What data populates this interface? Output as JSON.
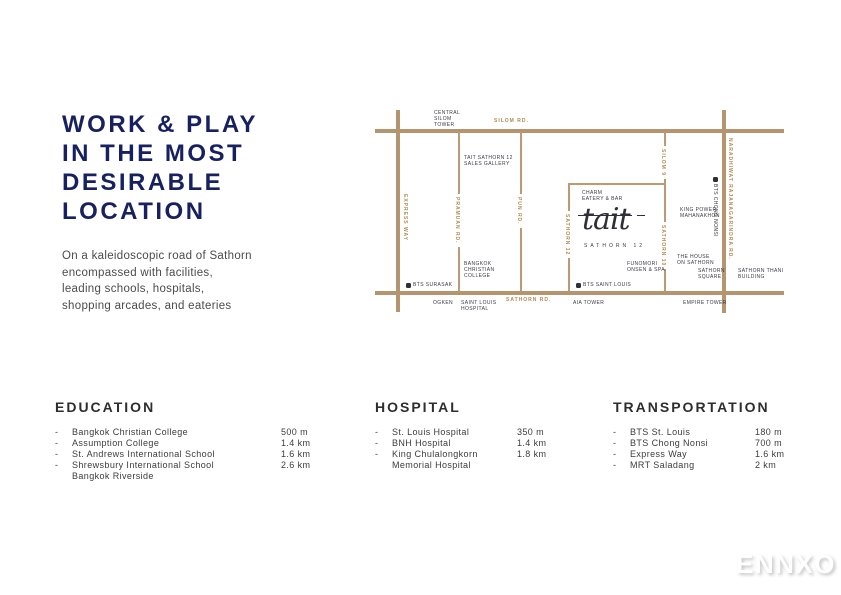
{
  "intro": {
    "title_lines": [
      "WORK & PLAY",
      "IN THE MOST",
      "DESIRABLE",
      "LOCATION"
    ],
    "description": "On a kaleidoscopic road of Sathorn encompassed with facilities, leading schools, hospitals, shopping arcades, and eateries"
  },
  "colors": {
    "heading_navy": "#17215f",
    "road_tan": "#b59470",
    "road_label_tan": "#b08a54",
    "map_text_dark": "#3a3b45"
  },
  "map": {
    "roads": {
      "silom": "SILOM RD.",
      "sathorn": "SATHORN RD.",
      "express_way": "EXPRESS WAY",
      "pramuan": "PRAMUAN RD.",
      "pun": "PUN RD.",
      "sathorn12": "SATHORN 12",
      "silom9": "SILOM 9",
      "sathorn10": "SATHORN 10",
      "naradhiwat": "NARADHIWAT RAJANAGARINDRA RD."
    },
    "places": {
      "central_silom_tower": "CENTRAL\nSILOM\nTOWER",
      "sales_gallery": "TAIT SATHORN 12\nSALES GALLERY",
      "bangkok_christian_college": "BANGKOK\nCHRISTIAN\nCOLLEGE",
      "bts_surasak": "BTS SURASAK",
      "ogken": "OGKEN",
      "saint_louis_hospital": "SAINT LOUIS\nHOSPITAL",
      "charm_eatery": "CHARM\nEATERY & BAR",
      "tait_logo": "tait",
      "tait_logo_sub": "SATHORN 12",
      "funomori": "FUNOMORI\nONSEN & SPA",
      "bts_saint_louis": "BTS SAINT LOUIS",
      "aia_tower": "AIA TOWER",
      "king_power": "KING POWER\nMAHANAKHON",
      "house_on_sathorn": "THE HOUSE\nON SATHORN",
      "sathorn_square": "SATHORN\nSQUARE",
      "sathorn_thani": "SATHORN THANI\nBUILDING",
      "empire_tower": "EMPIRE TOWER",
      "bts_chong_nonsi": "BTS CHONG NONSI"
    }
  },
  "sections": [
    {
      "title": "EDUCATION",
      "items": [
        {
          "name": "Bangkok Christian College",
          "distance": "500 m"
        },
        {
          "name": "Assumption College",
          "distance": "1.4 km"
        },
        {
          "name": "St. Andrews International School",
          "distance": "1.6 km"
        },
        {
          "name": "Shrewsbury International School\nBangkok Riverside",
          "distance": "2.6 km"
        }
      ]
    },
    {
      "title": "HOSPITAL",
      "items": [
        {
          "name": "St. Louis Hospital",
          "distance": "350 m"
        },
        {
          "name": "BNH Hospital",
          "distance": "1.4 km"
        },
        {
          "name": "King Chulalongkorn\nMemorial Hospital",
          "distance": "1.8 km"
        }
      ]
    },
    {
      "title": "TRANSPORTATION",
      "items": [
        {
          "name": "BTS St. Louis",
          "distance": "180 m"
        },
        {
          "name": "BTS Chong Nonsi",
          "distance": "700 m"
        },
        {
          "name": "Express Way",
          "distance": "1.6 km"
        },
        {
          "name": "MRT Saladang",
          "distance": "2 km"
        }
      ]
    }
  ],
  "watermark": "ENNXO"
}
